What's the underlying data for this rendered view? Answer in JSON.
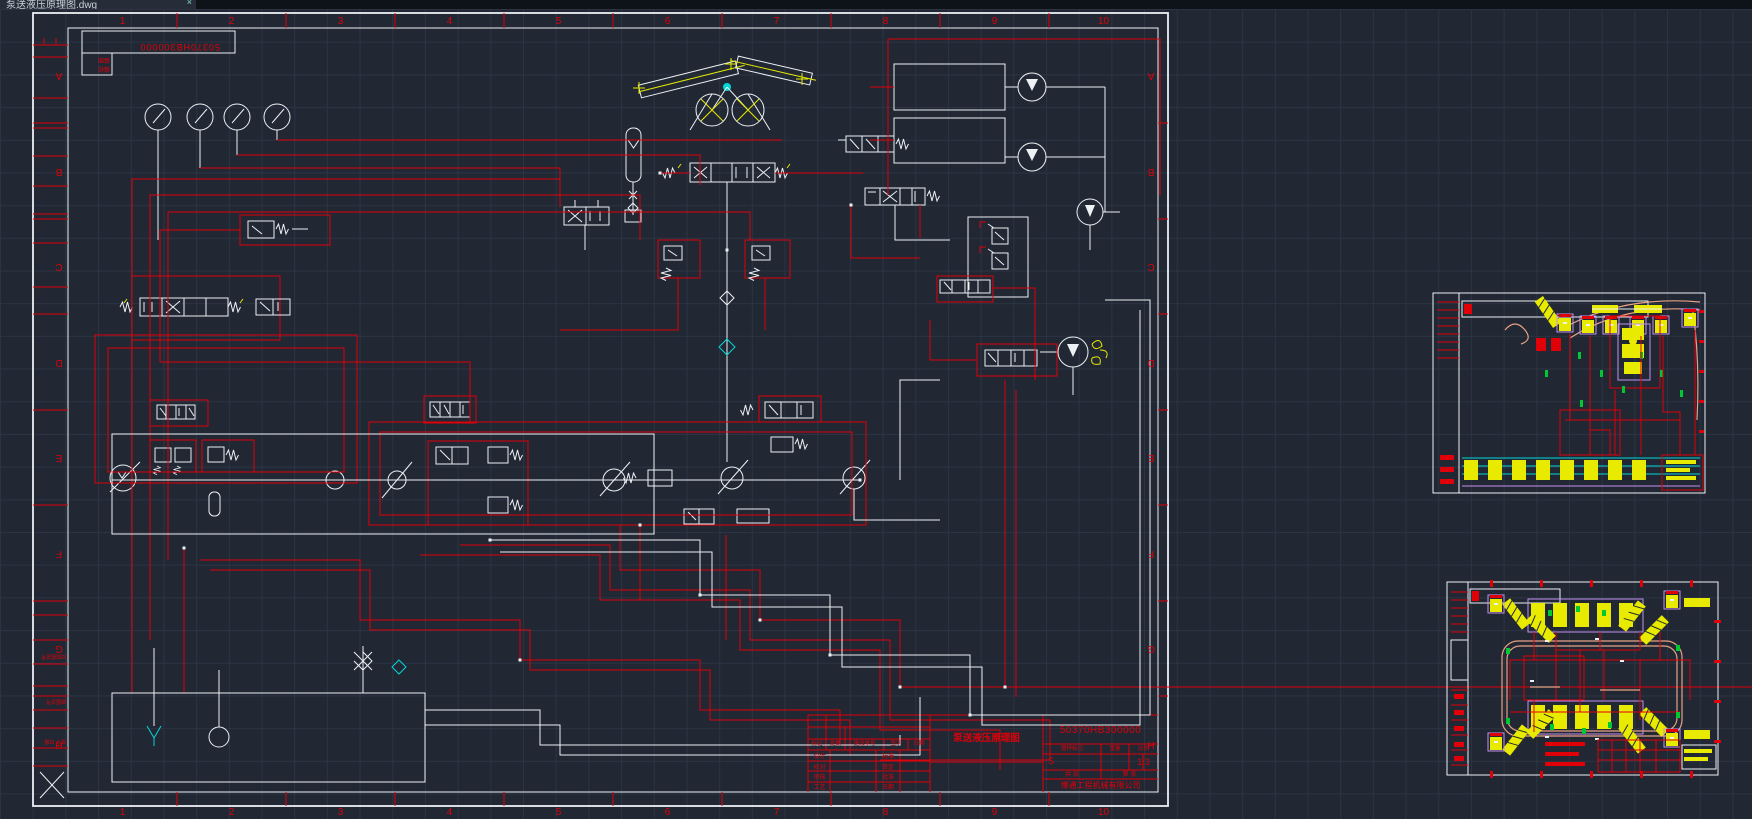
{
  "window": {
    "tab_title": "泵送液压原理图.dwg",
    "tab_close": "×"
  },
  "canvas": {
    "background": "#212834",
    "grid": "#2c3444",
    "colors": {
      "red": "#e00008",
      "white": "#edf1f4",
      "yellow": "#e8ea00",
      "cyan": "#00d8d8",
      "magenta": "#c390f0",
      "salmon": "#e8a184",
      "green": "#00c832"
    }
  },
  "sheet": {
    "zone_numbers": [
      "1",
      "2",
      "3",
      "4",
      "5",
      "6",
      "7",
      "8",
      "9",
      "10"
    ],
    "zone_letters": [
      "A",
      "B",
      "C",
      "D",
      "E",
      "F",
      "G",
      "H"
    ],
    "stamp": {
      "doc_no_rotated": "50370HB300000",
      "labels": [
        "描图",
        "描校"
      ]
    },
    "binding_strip": {
      "fields": [
        "旧底图总号",
        "底图总号",
        "签字  日期"
      ]
    },
    "title_block": {
      "doc_no": "50370HB300000",
      "title": "泵送液压原理图",
      "company": "博通工程机械有限公司",
      "change_header": [
        "标记",
        "处数",
        "更改单号",
        "签字",
        "日期"
      ],
      "sign_rows": [
        [
          "设计",
          "标准"
        ],
        [
          "校对",
          "审定"
        ],
        [
          "审核",
          "批准"
        ],
        [
          "工艺",
          "日期"
        ]
      ],
      "mark_labels": [
        "图样标记",
        "重量",
        "比例"
      ],
      "mark_values": [
        "S",
        "",
        "1:3"
      ],
      "sheet_labels": [
        "共  张",
        "第  张"
      ]
    }
  }
}
